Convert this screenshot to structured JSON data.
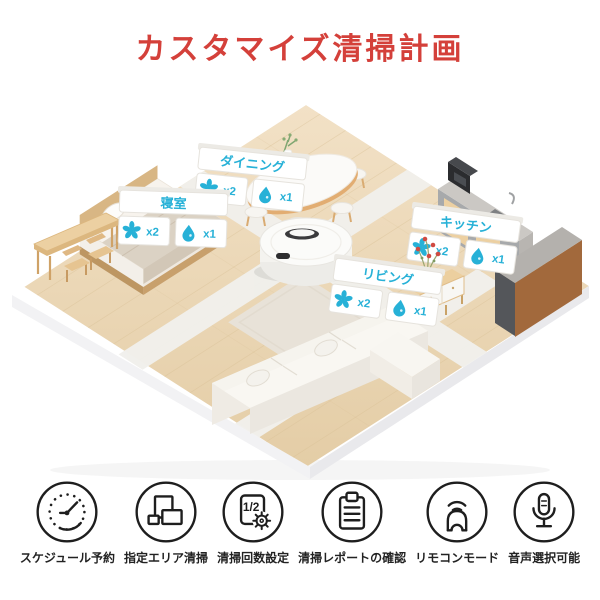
{
  "title": {
    "text": "カスタマイズ清掃計画",
    "color": "#d4403a"
  },
  "colors": {
    "accent_red": "#d4403a",
    "teal": "#27b1d7",
    "icon_black": "#1e1e1e",
    "wood_floor": "#ecd8b8"
  },
  "rooms": [
    {
      "id": "bedroom",
      "label": "寝室",
      "fan_count": "x2",
      "water_count": "x1"
    },
    {
      "id": "dining",
      "label": "ダイニング",
      "fan_count": "x2",
      "water_count": "x1"
    },
    {
      "id": "kitchen",
      "label": "キッチン",
      "fan_count": "x2",
      "water_count": "x1"
    },
    {
      "id": "living",
      "label": "リビング",
      "fan_count": "x2",
      "water_count": "x1"
    }
  ],
  "features": [
    {
      "icon": "schedule-clock-icon",
      "label": "スケジュール予約"
    },
    {
      "icon": "area-map-icon",
      "label": "指定エリア清掃"
    },
    {
      "icon": "count-setting-icon",
      "label": "清掃回数設定",
      "icon_text": "1/2"
    },
    {
      "icon": "report-clipboard-icon",
      "label": "清掃レポートの確認"
    },
    {
      "icon": "remote-control-icon",
      "label": "リモコンモード"
    },
    {
      "icon": "voice-mic-icon",
      "label": "音声選択可能"
    }
  ]
}
